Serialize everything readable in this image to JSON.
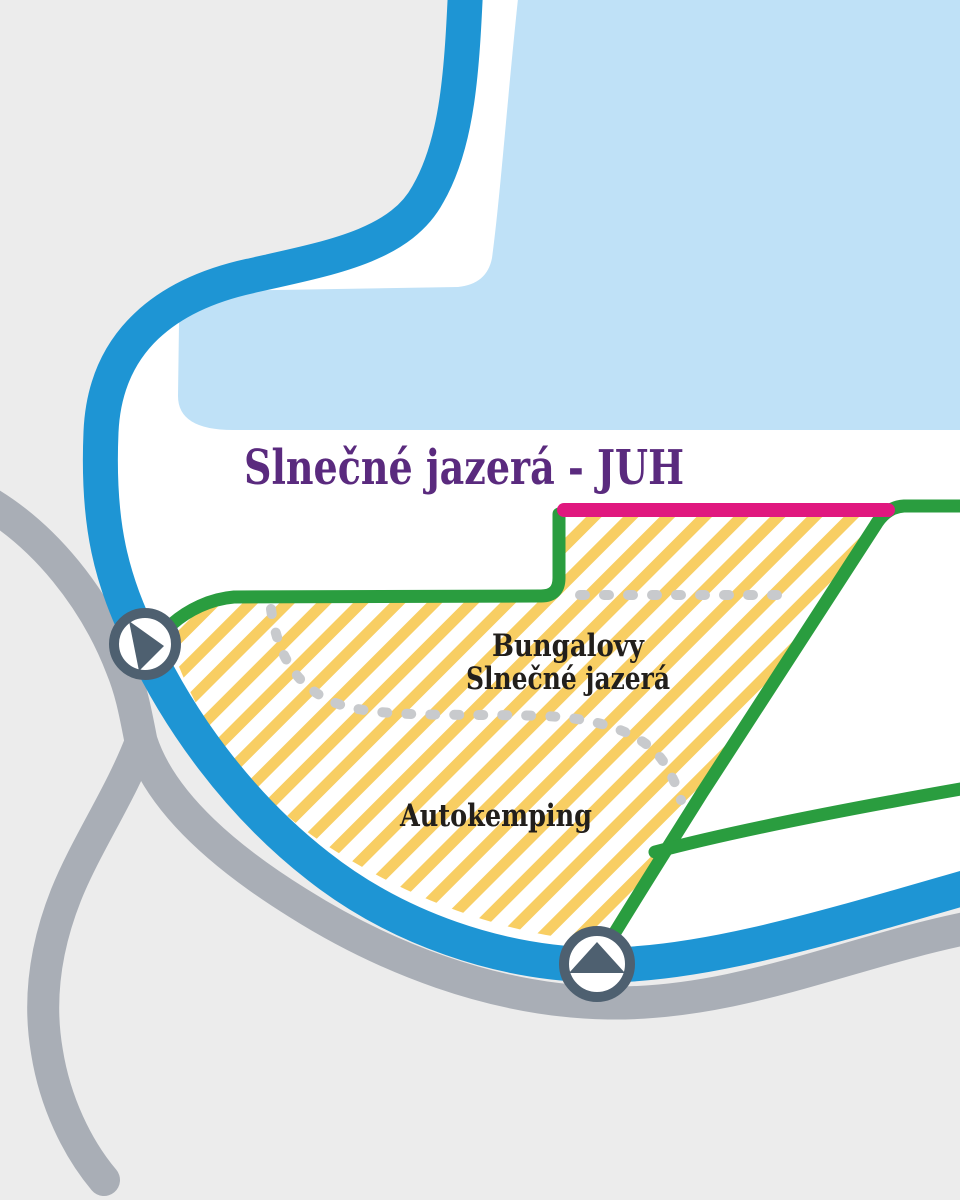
{
  "map": {
    "title": "Slnečné jazerá - JUH",
    "labels": {
      "bungalows_line1": "Bungalovy",
      "bungalows_line2": "Slnečné jazerá",
      "camping": "Autokemping"
    },
    "markers": [
      {
        "name": "west-entrance-arrow",
        "direction": "right"
      },
      {
        "name": "south-entrance-arrow",
        "direction": "up"
      }
    ],
    "colors": {
      "background": "#ECECEC",
      "inner_white": "#FFFFFF",
      "water": "#BFE1F7",
      "road_blue": "#1E95D4",
      "road_gray": "#A9AEB6",
      "boundary_green": "#2A9D3F",
      "entrance_pink": "#E0187F",
      "hatch_yellow": "#F8CE63",
      "hatch_base": "#FFFFFF",
      "dotted_path": "#C8CACD",
      "title_purple": "#5A2A7E",
      "label_black": "#221F1C",
      "marker_slate": "#4E6070",
      "marker_fill": "#FFFFFF"
    }
  }
}
